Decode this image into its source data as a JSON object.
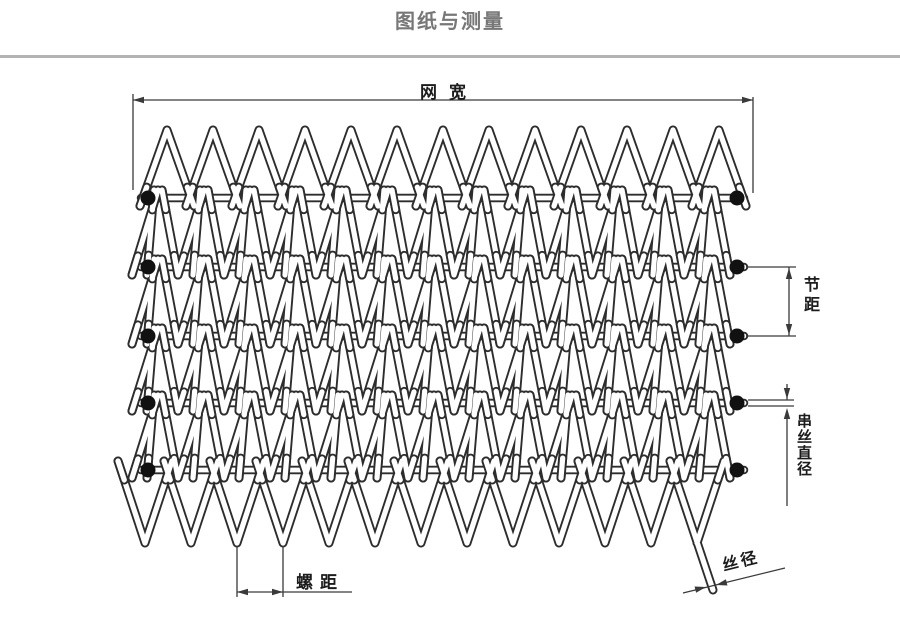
{
  "page": {
    "title": "图纸与测量",
    "title_color": "#777777",
    "divider_color": "#b3b3b3",
    "background_color": "#ffffff"
  },
  "diagram": {
    "labels": {
      "net_width": "网宽",
      "pitch": "节距",
      "cross_wire_diameter": "串丝直径",
      "spiral_pitch": "螺距",
      "wire_diameter": "丝径"
    },
    "colors": {
      "wire_outline": "#2d2d2d",
      "wire_fill": "#ffffff",
      "dimension_line": "#3a3a3a",
      "edge_dot": "#111111"
    },
    "structure": {
      "cross_rod_rows": 5,
      "edge_dots_per_side": 5,
      "top_peak_count": 13,
      "bottom_loop_count": 13
    }
  }
}
